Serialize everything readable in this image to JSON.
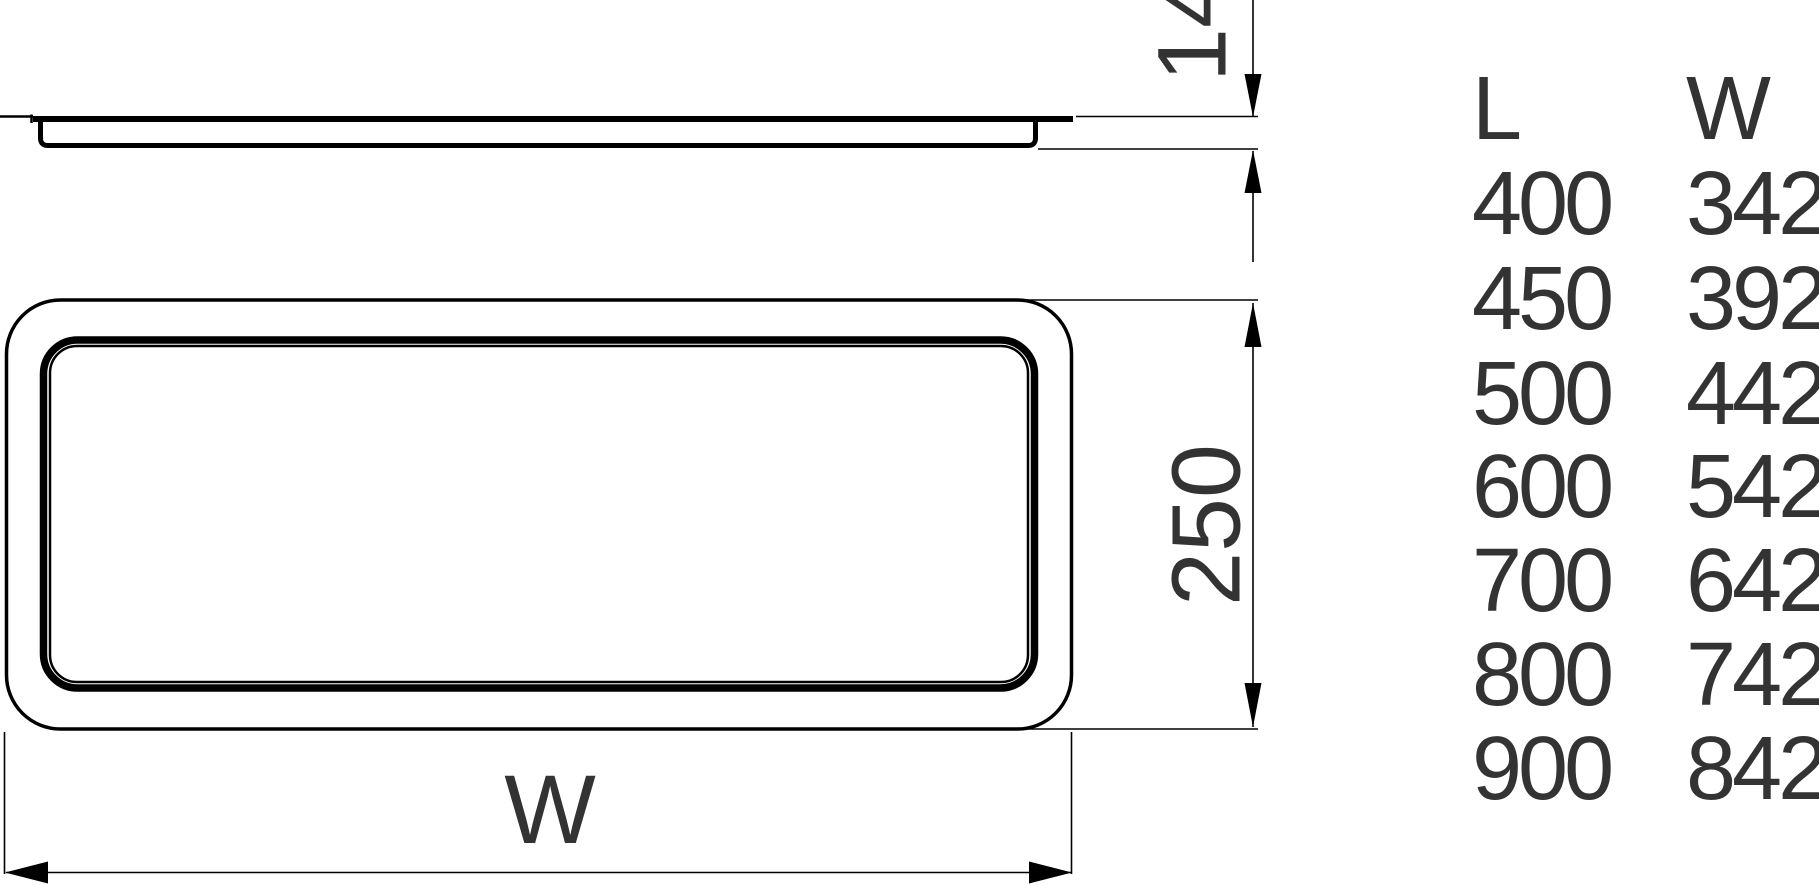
{
  "drawing": {
    "dimensions": {
      "thickness": "14",
      "depth": "250",
      "width_label": "W"
    },
    "size_table": {
      "headers": {
        "l": "L",
        "w": "W"
      },
      "rows": [
        {
          "l": "400",
          "w": "342"
        },
        {
          "l": "450",
          "w": "392"
        },
        {
          "l": "500",
          "w": "442"
        },
        {
          "l": "600",
          "w": "542"
        },
        {
          "l": "700",
          "w": "642"
        },
        {
          "l": "800",
          "w": "742"
        },
        {
          "l": "900",
          "w": "842"
        }
      ]
    },
    "colors": {
      "line": "#000000",
      "text": "#333333",
      "background": "#ffffff"
    }
  }
}
